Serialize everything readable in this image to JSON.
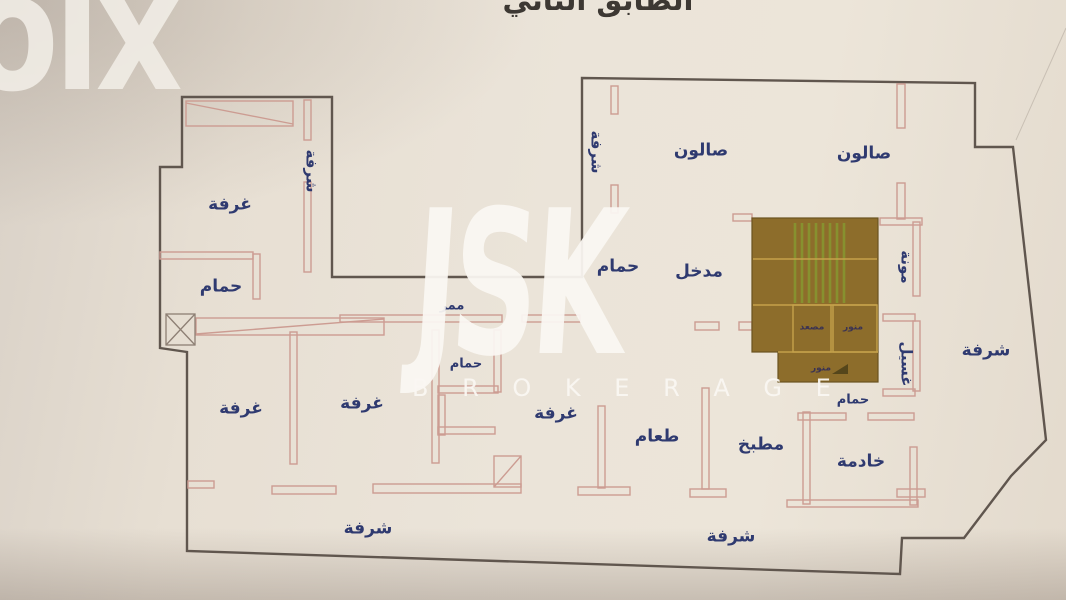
{
  "title": {
    "text": "الطابق الثاني",
    "note": "clipped at top edge of photo"
  },
  "watermarks": {
    "olx": "olx",
    "jsk": "JSK",
    "brokerage": "B R O K E R A G E"
  },
  "colors": {
    "paper": "#e8e0d4",
    "outline": "#60564e",
    "wall": "#cc9c92",
    "corefill": "#8d6d2b",
    "coreline": "#c6a24b",
    "stairs": "#87912f",
    "label": "#2f3a70",
    "corelabel": "#3b3352",
    "wm": "#f2eee7",
    "title": "#3d3833"
  },
  "plan": {
    "rooms": [
      {
        "id": "room-top-left",
        "label": "غرفة",
        "x": 230,
        "y": 205
      },
      {
        "id": "bath-top-left",
        "label": "حمام",
        "x": 221,
        "y": 287
      },
      {
        "id": "balcony-left-strip",
        "label": "شرفة",
        "x": 311,
        "y": 171,
        "vertical": true
      },
      {
        "id": "salon-1",
        "label": "صالون",
        "x": 701,
        "y": 151
      },
      {
        "id": "salon-2",
        "label": "صالون",
        "x": 864,
        "y": 154
      },
      {
        "id": "balcony-upper-strip",
        "label": "شرفة",
        "x": 596,
        "y": 152,
        "vertical": true
      },
      {
        "id": "bath-upper",
        "label": "حمام",
        "x": 618,
        "y": 267
      },
      {
        "id": "entrance",
        "label": "مدخل",
        "x": 699,
        "y": 272
      },
      {
        "id": "corridor",
        "label": "ممر",
        "x": 452,
        "y": 306,
        "small": true
      },
      {
        "id": "bath-middle",
        "label": "حمام",
        "x": 466,
        "y": 364,
        "small": true
      },
      {
        "id": "room-2",
        "label": "غرفة",
        "x": 241,
        "y": 409
      },
      {
        "id": "room-3",
        "label": "غرفة",
        "x": 362,
        "y": 404
      },
      {
        "id": "room-4",
        "label": "غرفة",
        "x": 556,
        "y": 414
      },
      {
        "id": "dining",
        "label": "طعام",
        "x": 657,
        "y": 437
      },
      {
        "id": "kitchen",
        "label": "مطبخ",
        "x": 761,
        "y": 445
      },
      {
        "id": "bath-right",
        "label": "حمام",
        "x": 853,
        "y": 400,
        "small": true
      },
      {
        "id": "maid-room",
        "label": "خادمة",
        "x": 861,
        "y": 462
      },
      {
        "id": "pantry",
        "label": "مونة",
        "x": 906,
        "y": 267,
        "vertical": true
      },
      {
        "id": "laundry",
        "label": "غسيل",
        "x": 906,
        "y": 364,
        "vertical": true
      },
      {
        "id": "balcony-right",
        "label": "شرفة",
        "x": 986,
        "y": 351
      },
      {
        "id": "balcony-bottom-left",
        "label": "شرفة",
        "x": 368,
        "y": 529
      },
      {
        "id": "balcony-bottom-right",
        "label": "شرفة",
        "x": 731,
        "y": 537
      },
      {
        "id": "elevator",
        "label": "مصعد",
        "x": 812,
        "y": 328,
        "core": true
      },
      {
        "id": "lightwell-1",
        "label": "منور",
        "x": 853,
        "y": 328,
        "core": true
      },
      {
        "id": "lightwell-2",
        "label": "منور",
        "x": 821,
        "y": 369,
        "core": true
      }
    ]
  }
}
